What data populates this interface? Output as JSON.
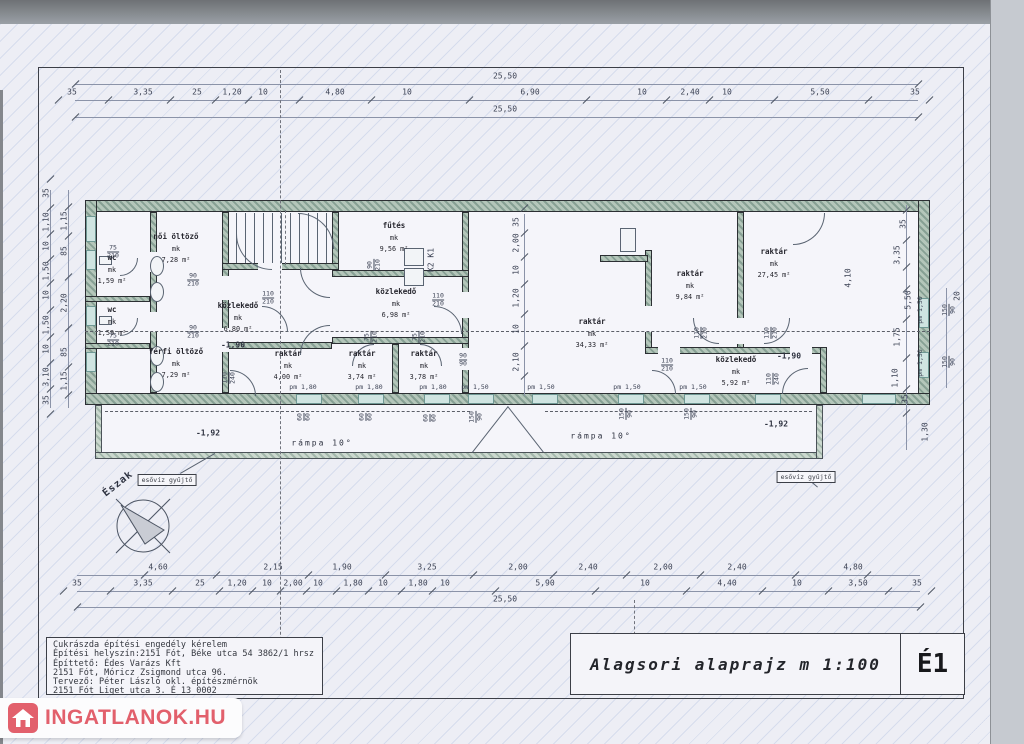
{
  "sheet": {
    "title": "Alagsori alaprajz m 1:100",
    "sheet_no": "É1",
    "title_block_lines": [
      "Cukrászda építési engedély kérelem",
      "Építési helyszín:2151 Fót, Béke utca 54 3862/1 hrsz",
      "Építtető: Édes Varázs Kft",
      "2151 Fót, Móricz Zsigmond utca 96.",
      "Tervező: Péter László okl. építészmérnök",
      "2151 Fót Liget utca 3. É 13 0002"
    ]
  },
  "watermark": {
    "text": "INGATLANOK.HU",
    "color": "#e2606c"
  },
  "compass": {
    "label": "Észak"
  },
  "plan": {
    "rooms": [
      {
        "name": "női öltöző",
        "mk": "mk",
        "area": "7,28 m²",
        "x": 176,
        "y": 247
      },
      {
        "name": "wc",
        "mk": "mk",
        "area": "1,59 m²",
        "x": 112,
        "y": 268
      },
      {
        "name": "wc",
        "mk": "mk",
        "area": "1,59 m²",
        "x": 112,
        "y": 320
      },
      {
        "name": "férfi öltöző",
        "mk": "mk",
        "area": "7,29 m²",
        "x": 176,
        "y": 362
      },
      {
        "name": "közlekedő",
        "mk": "mk",
        "area": "6,80 m²",
        "x": 238,
        "y": 316
      },
      {
        "name": "raktár",
        "mk": "mk",
        "area": "4,00 m²",
        "x": 288,
        "y": 364
      },
      {
        "name": "fűtés",
        "mk": "mk",
        "area": "9,56 m²",
        "x": 394,
        "y": 236
      },
      {
        "name": "közlekedő",
        "mk": "mk",
        "area": "6,98 m²",
        "x": 396,
        "y": 302
      },
      {
        "name": "raktár",
        "mk": "mk",
        "area": "3,74 m²",
        "x": 362,
        "y": 364
      },
      {
        "name": "raktár",
        "mk": "mk",
        "area": "3,78 m²",
        "x": 424,
        "y": 364
      },
      {
        "name": "raktár",
        "mk": "mk",
        "area": "34,33 m²",
        "x": 592,
        "y": 332
      },
      {
        "name": "raktár",
        "mk": "mk",
        "area": "9,84 m²",
        "x": 690,
        "y": 284
      },
      {
        "name": "raktár",
        "mk": "mk",
        "area": "27,45 m²",
        "x": 774,
        "y": 262
      },
      {
        "name": "közlekedő",
        "mk": "mk",
        "area": "5,92 m²",
        "x": 736,
        "y": 370
      }
    ],
    "levels": [
      {
        "t": "-1,90",
        "x": 233,
        "y": 345
      },
      {
        "t": "-1,90",
        "x": 789,
        "y": 356
      },
      {
        "t": "-1,92",
        "x": 208,
        "y": 433
      },
      {
        "t": "-1,92",
        "x": 776,
        "y": 424
      }
    ],
    "ramps": [
      {
        "t": "rámpa 10°",
        "x": 322,
        "y": 443
      },
      {
        "t": "rámpa 10°",
        "x": 601,
        "y": 436
      }
    ],
    "notes": [
      {
        "t": "esővíz gyűjtő",
        "x": 167,
        "y": 480
      },
      {
        "t": "esővíz gyűjtő",
        "x": 806,
        "y": 477
      }
    ],
    "misc": [
      {
        "t": "K2  K1",
        "x": 431,
        "y": 260,
        "r": -90
      }
    ],
    "pm_labels": [
      {
        "t": "pm 1,80",
        "x": 303,
        "y": 387
      },
      {
        "t": "pm 1,80",
        "x": 369,
        "y": 387
      },
      {
        "t": "pm 1,80",
        "x": 433,
        "y": 387
      },
      {
        "t": "pm 1,50",
        "x": 475,
        "y": 387
      },
      {
        "t": "pm 1,50",
        "x": 541,
        "y": 387
      },
      {
        "t": "pm 1,50",
        "x": 627,
        "y": 387
      },
      {
        "t": "pm 1,50",
        "x": 693,
        "y": 387
      },
      {
        "t": "pm 1,50",
        "x": 920,
        "y": 310,
        "r": -90
      },
      {
        "t": "pm 1,50",
        "x": 920,
        "y": 363,
        "r": -90
      }
    ],
    "frac_dims": [
      {
        "a": "90",
        "b": "210",
        "x": 193,
        "y": 280
      },
      {
        "a": "90",
        "b": "210",
        "x": 193,
        "y": 332
      },
      {
        "a": "75",
        "b": "210",
        "x": 113,
        "y": 252
      },
      {
        "a": "75",
        "b": "210",
        "x": 113,
        "y": 340
      },
      {
        "a": "110",
        "b": "210",
        "x": 268,
        "y": 298
      },
      {
        "a": "110",
        "b": "210",
        "x": 438,
        "y": 300
      },
      {
        "a": "90",
        "b": "210",
        "x": 374,
        "y": 265,
        "r": -90
      },
      {
        "a": "75",
        "b": "210",
        "x": 371,
        "y": 337,
        "r": -90
      },
      {
        "a": "75",
        "b": "210",
        "x": 419,
        "y": 337,
        "r": -90
      },
      {
        "a": "90",
        "b": "90",
        "x": 463,
        "y": 360
      },
      {
        "a": "110",
        "b": "240",
        "x": 229,
        "y": 378,
        "r": -90
      },
      {
        "a": "110",
        "b": "210",
        "x": 701,
        "y": 333,
        "r": -90
      },
      {
        "a": "110",
        "b": "210",
        "x": 771,
        "y": 333,
        "r": -90
      },
      {
        "a": "110",
        "b": "210",
        "x": 667,
        "y": 365
      },
      {
        "a": "110",
        "b": "240",
        "x": 773,
        "y": 379,
        "r": -90
      },
      {
        "a": "60",
        "b": "60",
        "x": 304,
        "y": 417,
        "r": -90
      },
      {
        "a": "60",
        "b": "60",
        "x": 366,
        "y": 417,
        "r": -90
      },
      {
        "a": "60",
        "b": "60",
        "x": 430,
        "y": 418,
        "r": -90
      },
      {
        "a": "150",
        "b": "90",
        "x": 476,
        "y": 417,
        "r": -90
      },
      {
        "a": "150",
        "b": "90",
        "x": 626,
        "y": 414,
        "r": -90
      },
      {
        "a": "150",
        "b": "90",
        "x": 691,
        "y": 414,
        "r": -90
      },
      {
        "a": "150",
        "b": "90",
        "x": 949,
        "y": 310,
        "r": -90
      },
      {
        "a": "150",
        "b": "90",
        "x": 949,
        "y": 362,
        "r": -90
      }
    ]
  },
  "dims": {
    "top": {
      "overall": "25,50",
      "overall2": "25,50",
      "segments": [
        {
          "t": "35",
          "x": 72
        },
        {
          "t": "3,35",
          "x": 143
        },
        {
          "t": "25",
          "x": 197
        },
        {
          "t": "1,20",
          "x": 232
        },
        {
          "t": "10",
          "x": 263
        },
        {
          "t": "4,80",
          "x": 335
        },
        {
          "t": "10",
          "x": 407
        },
        {
          "t": "6,90",
          "x": 530
        },
        {
          "t": "10",
          "x": 642
        },
        {
          "t": "2,40",
          "x": 690
        },
        {
          "t": "10",
          "x": 727
        },
        {
          "t": "5,50",
          "x": 820
        },
        {
          "t": "35",
          "x": 915
        }
      ]
    },
    "bottom": {
      "overall": "25,50",
      "row1": [
        {
          "t": "4,60",
          "x": 158
        },
        {
          "t": "2,15",
          "x": 273
        },
        {
          "t": "1,90",
          "x": 342
        },
        {
          "t": "3,25",
          "x": 427
        },
        {
          "t": "2,00",
          "x": 518
        },
        {
          "t": "2,40",
          "x": 588
        },
        {
          "t": "2,00",
          "x": 663
        },
        {
          "t": "2,40",
          "x": 737
        },
        {
          "t": "4,80",
          "x": 853
        }
      ],
      "row2": [
        {
          "t": "35",
          "x": 77
        },
        {
          "t": "3,35",
          "x": 143
        },
        {
          "t": "25",
          "x": 200
        },
        {
          "t": "1,20",
          "x": 237
        },
        {
          "t": "10",
          "x": 267
        },
        {
          "t": "2,00",
          "x": 293
        },
        {
          "t": "10",
          "x": 318
        },
        {
          "t": "1,80",
          "x": 353
        },
        {
          "t": "10",
          "x": 383
        },
        {
          "t": "1,80",
          "x": 418
        },
        {
          "t": "10",
          "x": 445
        },
        {
          "t": "5,90",
          "x": 545
        },
        {
          "t": "10",
          "x": 645
        },
        {
          "t": "4,40",
          "x": 727
        },
        {
          "t": "10",
          "x": 797
        },
        {
          "t": "3,50",
          "x": 858
        },
        {
          "t": "35",
          "x": 917
        }
      ]
    },
    "left": {
      "outer": [
        {
          "t": "35",
          "y": 193
        },
        {
          "t": "1,10",
          "y": 222
        },
        {
          "t": "10",
          "y": 246
        },
        {
          "t": "1,50",
          "y": 271
        },
        {
          "t": "10",
          "y": 295
        },
        {
          "t": "1,50",
          "y": 325
        },
        {
          "t": "10",
          "y": 349
        },
        {
          "t": "3,10",
          "y": 377
        },
        {
          "t": "35",
          "y": 400
        }
      ],
      "inner": [
        {
          "t": "1,15",
          "y": 221
        },
        {
          "t": "85",
          "y": 251
        },
        {
          "t": "2,20",
          "y": 303
        },
        {
          "t": "85",
          "y": 352
        },
        {
          "t": "1,15",
          "y": 381
        }
      ]
    },
    "right": {
      "labels": [
        {
          "t": "35",
          "x": 903,
          "y": 224
        },
        {
          "t": "3,35",
          "x": 897,
          "y": 255
        },
        {
          "t": "4,10",
          "x": 848,
          "y": 278
        },
        {
          "t": "5,50",
          "x": 908,
          "y": 300
        },
        {
          "t": "1,75",
          "x": 897,
          "y": 337
        },
        {
          "t": "1,10",
          "x": 895,
          "y": 378
        },
        {
          "t": "35",
          "x": 905,
          "y": 399
        },
        {
          "t": "1,30",
          "x": 925,
          "y": 432
        },
        {
          "t": "20",
          "x": 957,
          "y": 296
        }
      ]
    },
    "middle": {
      "x": 516,
      "labels": [
        {
          "t": "35",
          "y": 222
        },
        {
          "t": "2,00",
          "y": 243
        },
        {
          "t": "10",
          "y": 270
        },
        {
          "t": "1,20",
          "y": 298
        },
        {
          "t": "10",
          "y": 329
        },
        {
          "t": "2,10",
          "y": 362
        }
      ]
    }
  }
}
